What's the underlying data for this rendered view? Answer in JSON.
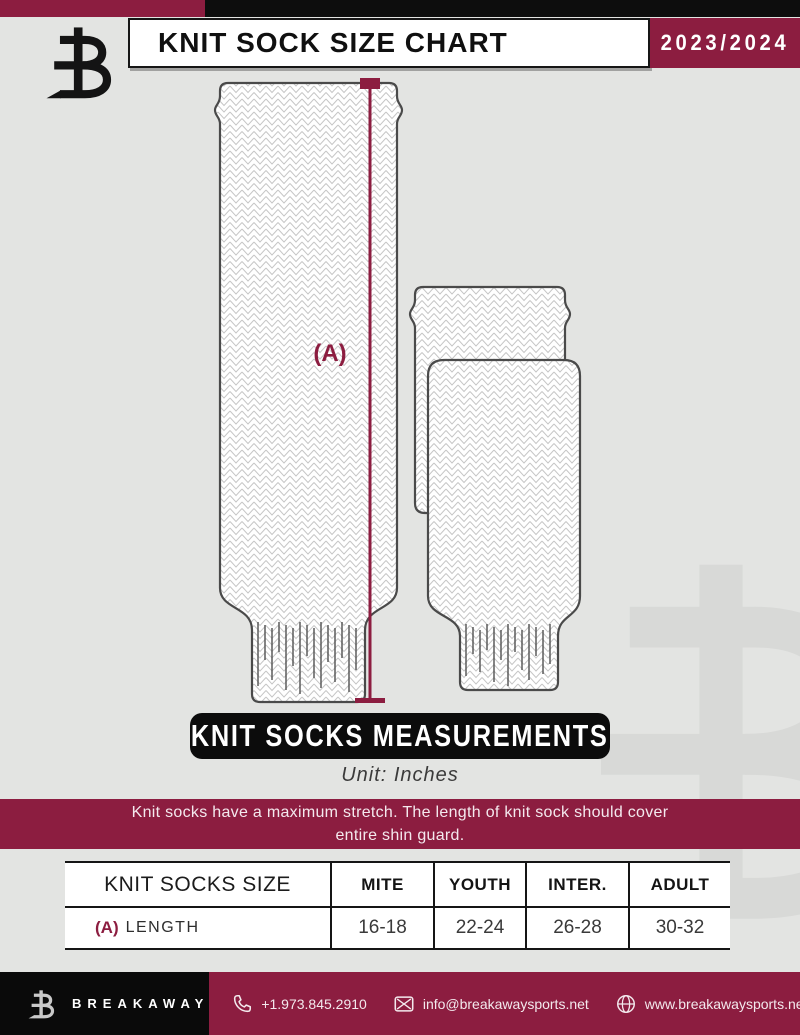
{
  "header": {
    "title": "KNIT SOCK SIZE CHART",
    "season": "2023/2024"
  },
  "diagram": {
    "measure_label": "(A)"
  },
  "banner": {
    "title": "KNIT SOCKS MEASUREMENTS",
    "unit": "Unit: Inches"
  },
  "note": {
    "line1": "Knit socks have a maximum stretch. The length of knit sock should cover",
    "line2": "entire shin guard."
  },
  "table": {
    "size_header": "KNIT SOCKS SIZE",
    "columns": [
      "MITE",
      "YOUTH",
      "INTER.",
      "ADULT"
    ],
    "rows": [
      {
        "label_key": "(A)",
        "label": "LENGTH",
        "values": [
          "16-18",
          "22-24",
          "26-28",
          "30-32"
        ]
      }
    ]
  },
  "footer": {
    "brand": "BREAKAWAY",
    "phone": "+1.973.845.2910",
    "email": "info@breakawaysports.net",
    "website": "www.breakawaysports.net"
  },
  "colors": {
    "maroon": "#8C1D40",
    "black": "#0D0D0D",
    "background": "#E3E4E2",
    "sock_outline": "#4a4a4a",
    "knit_pattern": "#c6c6c6"
  }
}
